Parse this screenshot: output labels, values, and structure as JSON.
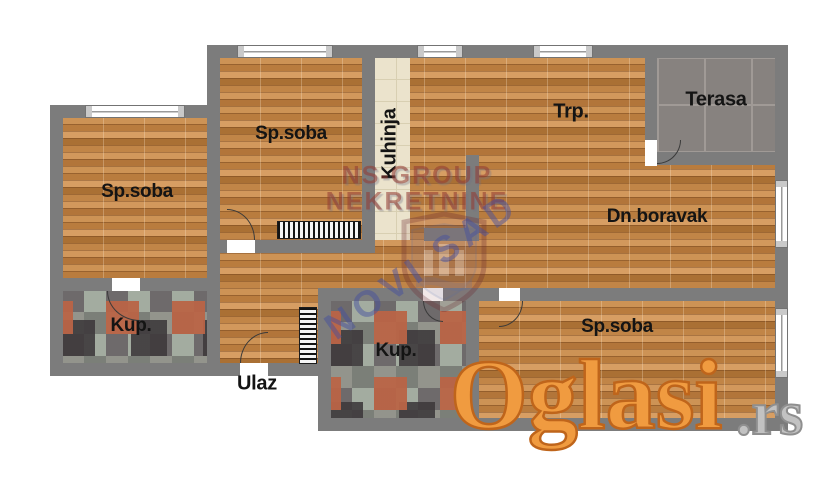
{
  "rooms": {
    "bedroom_left": "Sp.soba",
    "bedroom_top": "Sp.soba",
    "bedroom_bottom": "Sp.soba",
    "kitchen": "Kuhinja",
    "dining": "Trp.",
    "terrace": "Terasa",
    "living": "Dn.boravak",
    "bathroom_left": "Kup.",
    "bathroom_middle": "Kup.",
    "entrance": "Ulaz"
  },
  "watermarks": {
    "agency_line1": "NS-GROUP",
    "agency_line2": "NEKRETNINE",
    "city": "NOVI SAD",
    "site": "Oglasi",
    "site_tld": ".rs"
  },
  "colors": {
    "wall": "#7c7c7c",
    "wood_floor": "#c08346",
    "kitchen_tile": "#ebe3cc",
    "terrace_tile": "#87827f",
    "bath_tile": "#8f8d88",
    "watermark_red": "#943a32",
    "watermark_blue": "#46509e",
    "watermark_orange": "#f09b40"
  }
}
